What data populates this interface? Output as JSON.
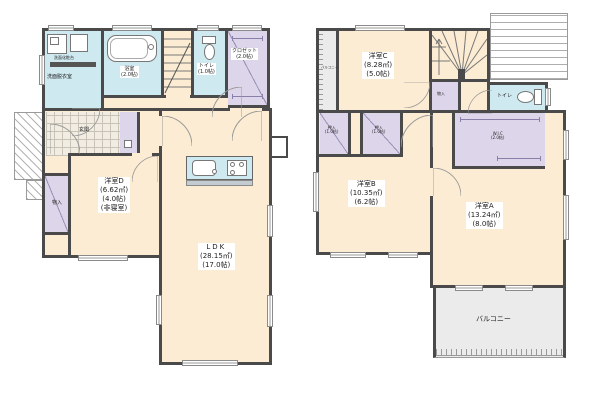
{
  "colors": {
    "wall": "#4a4a4a",
    "room_cream": "#fcecd3",
    "wet_blue": "#cfe9f1",
    "closet_purple": "#ddd6eb",
    "balcony_gray": "#ebebeb"
  },
  "floor1": {
    "washroom": {
      "name": "洗面脱衣室",
      "vanity": "洗面化粧台"
    },
    "bath": {
      "name": "浴室",
      "size": "(2.0帖)"
    },
    "toilet": {
      "name": "トイレ",
      "size": "(1.0帖)"
    },
    "closet": {
      "name": "クロゼット",
      "size": "(2.0帖)"
    },
    "entrance": {
      "name": "玄関"
    },
    "storage": {
      "name": "物入"
    },
    "room_d": {
      "name": "洋室D",
      "m2": "(6.62㎡)",
      "jo": "(4.0帖)",
      "note": "(非寝室)"
    },
    "ldk": {
      "name": "LDK",
      "m2": "(28.15㎡)",
      "jo": "(17.0帖)"
    }
  },
  "floor2": {
    "balcony_side": {
      "name": "バルコニー"
    },
    "room_c": {
      "name": "洋室C",
      "m2": "(8.28㎡)",
      "jo": "(5.0帖)"
    },
    "storage": {
      "name": "物入"
    },
    "toilet": {
      "name": "トイレ"
    },
    "oshiire_1": {
      "name": "押入",
      "size": "(1.0帖)"
    },
    "oshiire_2": {
      "name": "押入",
      "size": "(1.0帖)"
    },
    "wic": {
      "name": "W.I.C",
      "size": "(2.0帖)"
    },
    "room_b": {
      "name": "洋室B",
      "m2": "(10.35㎡)",
      "jo": "(6.2帖)"
    },
    "room_a": {
      "name": "洋室A",
      "m2": "(13.24㎡)",
      "jo": "(8.0帖)"
    },
    "balcony": {
      "name": "バルコニー"
    }
  }
}
